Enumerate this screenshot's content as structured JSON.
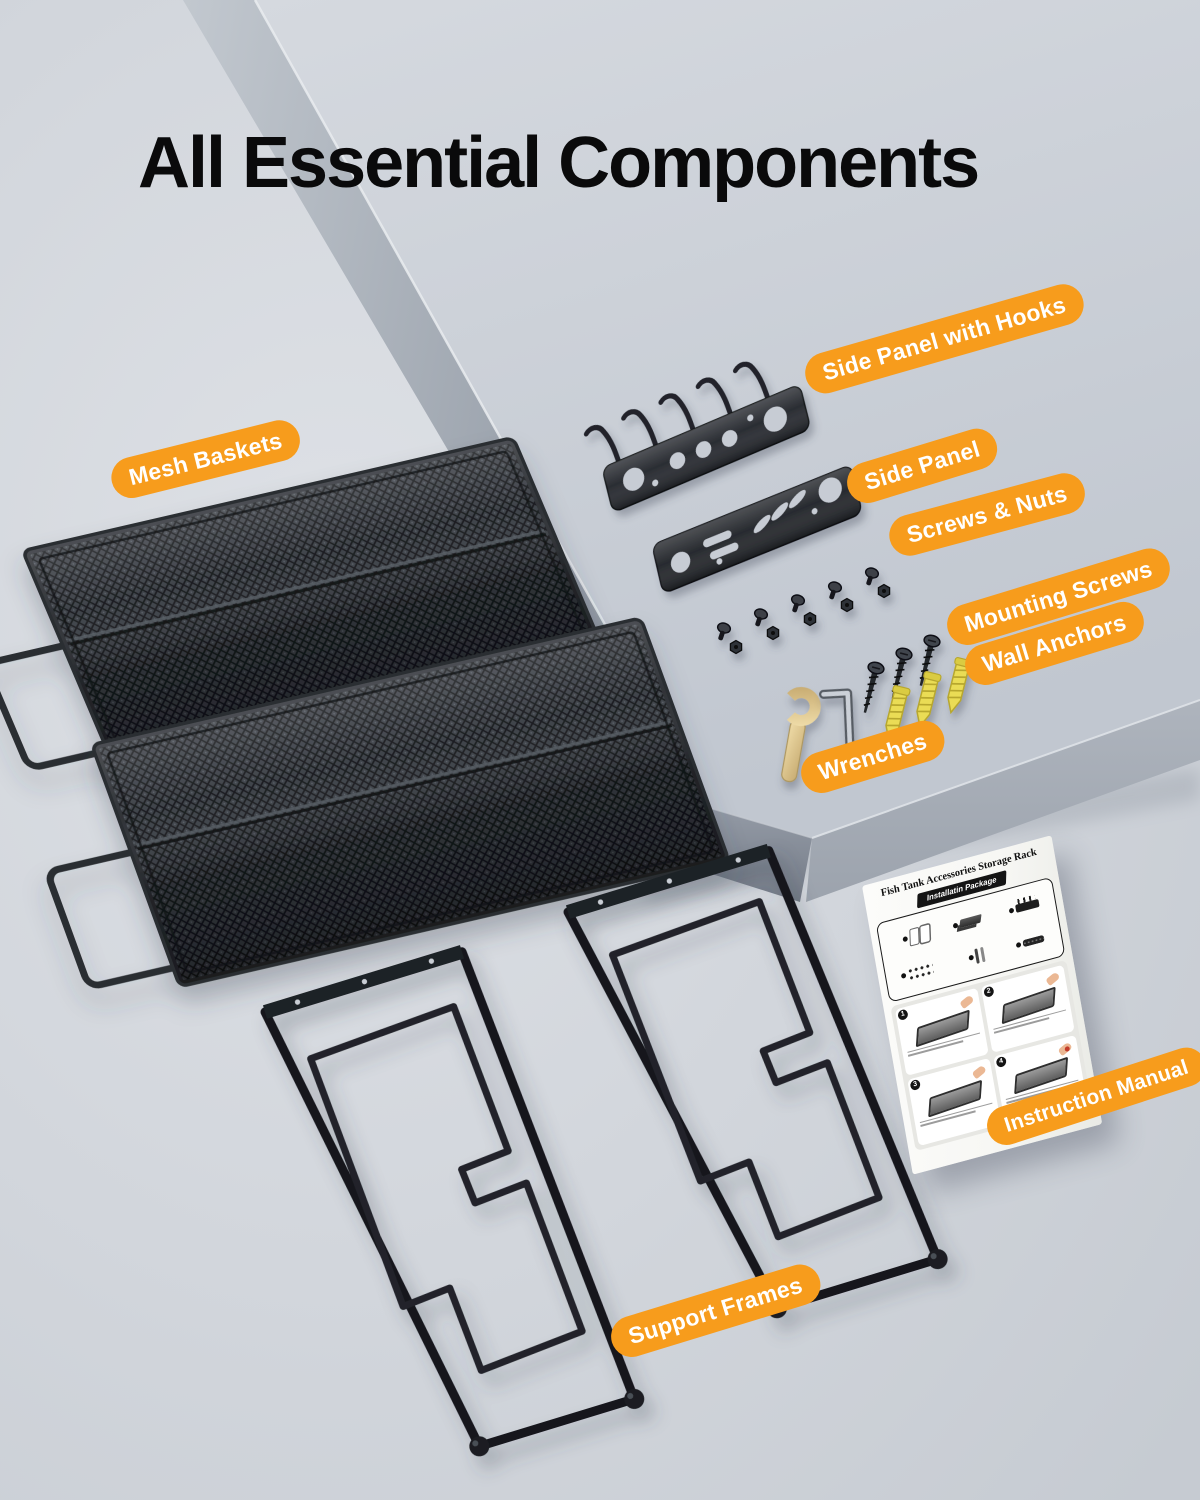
{
  "page": {
    "title": "All Essential Components"
  },
  "labels": {
    "mesh_baskets": "Mesh Baskets",
    "side_panel_with_hooks": "Side Panel with Hooks",
    "side_panel": "Side Panel",
    "screws_nuts": "Screws & Nuts",
    "mounting_screws": "Mounting Screws",
    "wall_anchors": "Wall Anchors",
    "wrenches": "Wrenches",
    "instruction_manual": "Instruction Manual",
    "support_frames": "Support Frames"
  },
  "manual": {
    "title": "Fish Tank Accessories Storage Rack",
    "badge": "Installatin Package",
    "steps": [
      "1",
      "2",
      "3",
      "4"
    ]
  },
  "components": {
    "mesh_baskets": 2,
    "support_frames": 2,
    "side_panels": 2,
    "screw_nut_pairs": 5,
    "mounting_screws": 3,
    "wall_anchors": 3,
    "wrenches": 2,
    "instruction_manuals": 1
  },
  "colors": {
    "accent_orange": "#F79C1C",
    "label_text": "#FFFFFF",
    "title_text": "#0A0A0B",
    "background_gray": "#D7DBE1",
    "platform_side_gray": "#99A1AC",
    "metal_black": "#24272C",
    "anchor_yellow": "#EADC55",
    "wrench_gold": "#DCC493",
    "paper_white": "#FBFBF8"
  }
}
